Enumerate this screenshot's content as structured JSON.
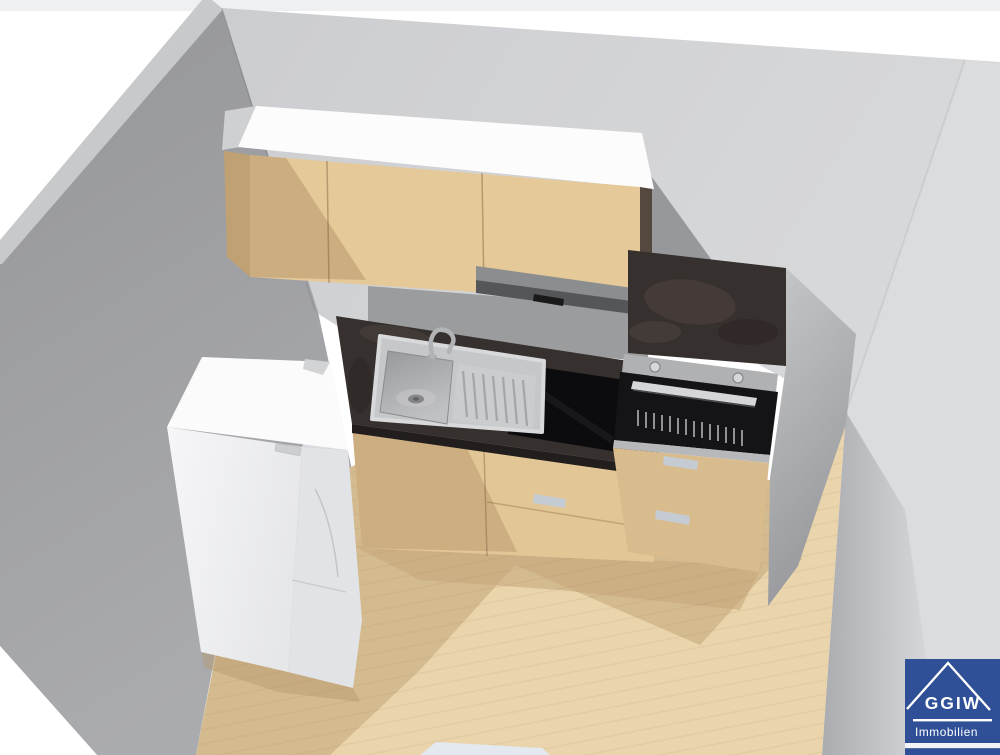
{
  "logo": {
    "brand": "GGIW",
    "subtitle": "Immobilien"
  },
  "colors": {
    "background": "#ffffff",
    "top_strip": "#eff0f1",
    "wall_back": "#d2d3d5",
    "wall_right": "#dadcde",
    "wall_left": "#9ea0a2",
    "wall_edge": "#c8c9cb",
    "wall_splash": "#9b9c9e",
    "wall_shadow_triangle": "#97989b",
    "floor_light": "#e9d4ac",
    "floor_shadow": "#d4ba8f",
    "floor_deep": "#c7a87c",
    "floor_object": "#e4e8ef",
    "wood_upper": "#e5c998",
    "wood_upper_shadow": "#cbad7f",
    "wood_end": "#bfa173",
    "wood_base": "#e2c696",
    "wood_base_shadow": "#ccae81",
    "cabinet_top_white": "#fcfcfd",
    "cabinet_right_edge": "#55493f",
    "hood_top": "#8c8d8f",
    "hood_front": "#55565a",
    "hood_slot": "#1a1a1b",
    "counter_dark": "#36302e",
    "counter_edge": "#221e1d",
    "cooktop_black": "#0c0c0e",
    "sink_gray": "#c6c7c9",
    "sink_basin_dark": "#9c9d9f",
    "faucet_gray": "#b2b3b5",
    "oven_panel": "#b0b1b3",
    "oven_door": "#141417",
    "oven_handle": "#d5d6d8",
    "drawer_handle": "#c5cbd2",
    "fridge_top": "#fbfbfc",
    "fridge_door": "#e2e3e6",
    "fridge_detail": "#cdced0",
    "logo_blue": "#2f4f96",
    "logo_text": "#ffffff"
  }
}
